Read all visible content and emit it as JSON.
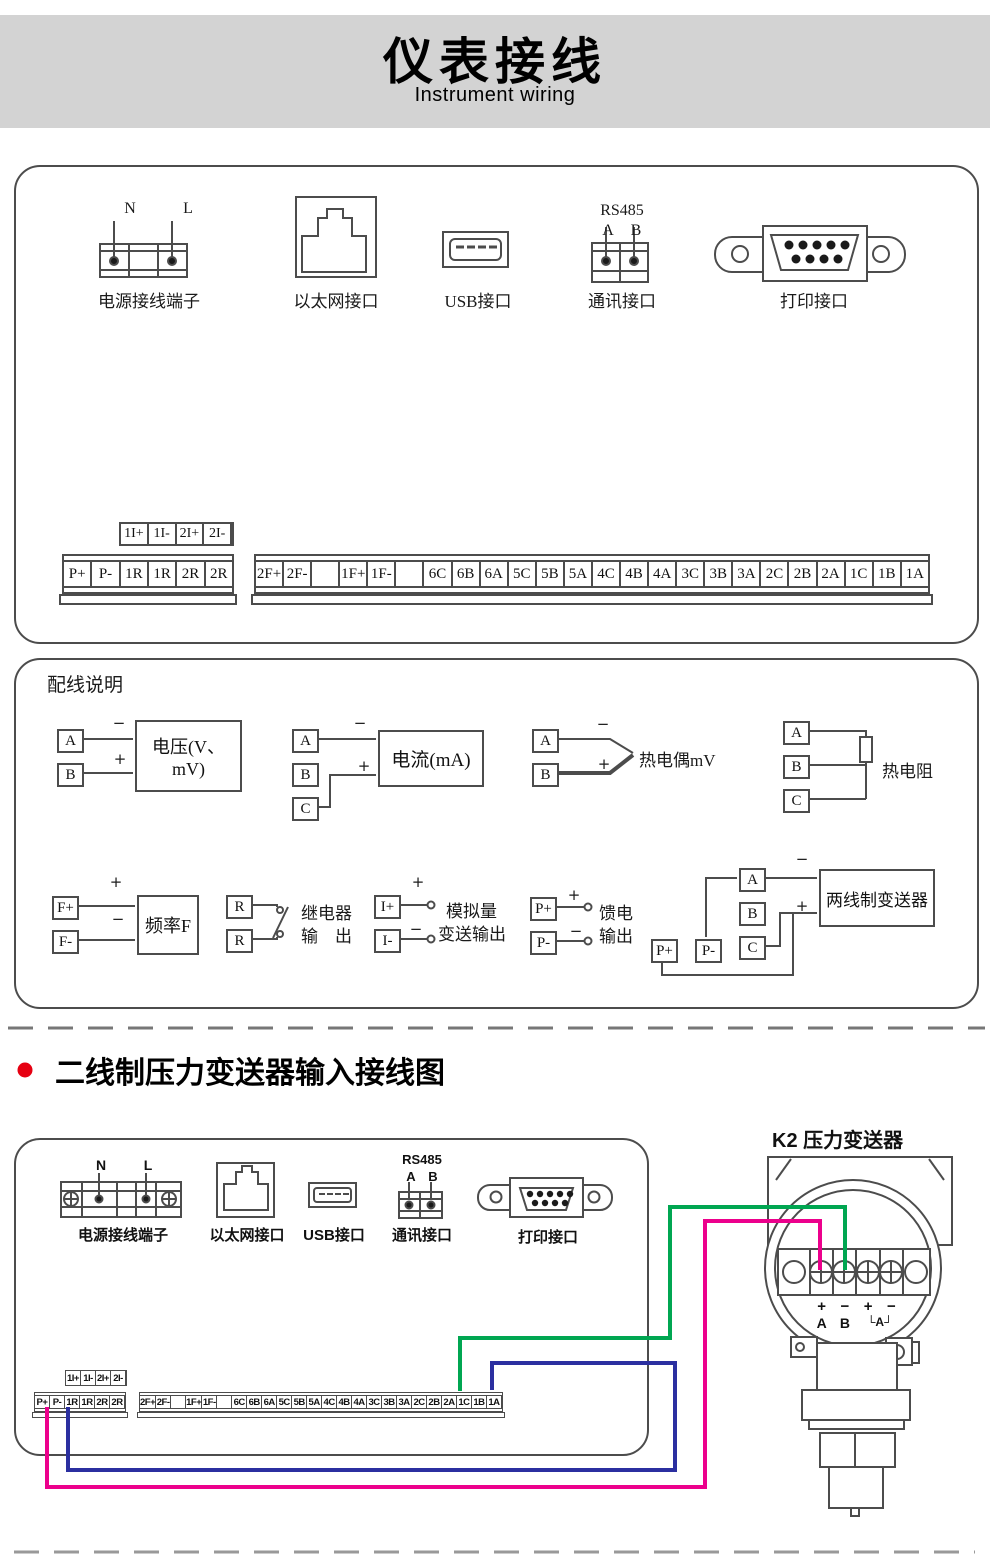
{
  "banner": {
    "title": "仪表接线",
    "subtitle": "Instrument wiring"
  },
  "sym": {
    "plus": "+",
    "minus": "−"
  },
  "box1": {
    "connectors": {
      "power": {
        "label": "电源接线端子",
        "pins": [
          "N",
          "L"
        ]
      },
      "ethernet": {
        "label": "以太网接口"
      },
      "usb": {
        "label": "USB接口"
      },
      "comm": {
        "label": "通讯接口",
        "bus": "RS485",
        "pins": [
          "A",
          "B"
        ]
      },
      "printer": {
        "label": "打印接口"
      }
    },
    "strips": {
      "aux": [
        "1I+",
        "1I-",
        "2I+",
        "2I-"
      ],
      "left": [
        "P+",
        "P-",
        "1R",
        "1R",
        "2R",
        "2R"
      ],
      "right": [
        "2F+",
        "2F-",
        "",
        "1F+",
        "1F-",
        "",
        "6C",
        "6B",
        "6A",
        "5C",
        "5B",
        "5A",
        "4C",
        "4B",
        "4A",
        "3C",
        "3B",
        "3A",
        "2C",
        "2B",
        "2A",
        "1C",
        "1B",
        "1A"
      ]
    }
  },
  "box2": {
    "title": "配线说明",
    "volt": {
      "terminals": [
        "A",
        "B"
      ],
      "device": "电压(V、mV)"
    },
    "amp": {
      "terminals": [
        "A",
        "B",
        "C"
      ],
      "device": "电流(mA)"
    },
    "tc": {
      "terminals": [
        "A",
        "B"
      ],
      "label": "热电偶mV"
    },
    "rtd": {
      "terminals": [
        "A",
        "B",
        "C"
      ],
      "label": "热电阻"
    },
    "freq": {
      "terminals": [
        "F+",
        "F-"
      ],
      "device": "频率F"
    },
    "relay": {
      "terminals": [
        "R",
        "R"
      ],
      "line1": "继电器",
      "line2": "输　出"
    },
    "analog": {
      "terminals": [
        "I+",
        "I-"
      ],
      "line1": "模拟量",
      "line2": "变送输出"
    },
    "feed": {
      "terminals": [
        "P+",
        "P-"
      ],
      "line1": "馈电",
      "line2": "输出"
    },
    "twowire": {
      "terminals": [
        "A",
        "B",
        "C"
      ],
      "aux": [
        "P+",
        "P-"
      ],
      "device": "两线制变送器"
    }
  },
  "section2": {
    "title": "二线制压力变送器输入接线图",
    "bullet_color": "#e60012"
  },
  "box3": {
    "connectors": {
      "power": {
        "label": "电源接线端子",
        "pins": [
          "N",
          "L"
        ]
      },
      "ethernet": {
        "label": "以太网接口"
      },
      "usb": {
        "label": "USB接口"
      },
      "comm": {
        "label": "通讯接口",
        "bus": "RS485",
        "pins": [
          "A",
          "B"
        ]
      },
      "printer": {
        "label": "打印接口"
      }
    },
    "strips": {
      "aux": [
        "1I+",
        "1I-",
        "2I+",
        "2I-"
      ],
      "left": [
        "P+",
        "P-",
        "1R",
        "1R",
        "2R",
        "2R"
      ],
      "right": [
        "2F+",
        "2F-",
        "",
        "1F+",
        "1F-",
        "",
        "6C",
        "6B",
        "6A",
        "5C",
        "5B",
        "5A",
        "4C",
        "4B",
        "4A",
        "3C",
        "3B",
        "3A",
        "2C",
        "2B",
        "2A",
        "1C",
        "1B",
        "1A"
      ]
    }
  },
  "transmitter": {
    "title": "K2 压力变送器",
    "signs": [
      "+",
      "−",
      "+",
      "−"
    ],
    "pins": [
      "A",
      "B",
      "└A┘"
    ]
  },
  "wires": {
    "plus_color": "#ec008c",
    "minus_color": "#00a651",
    "return_color": "#2b2fa0"
  }
}
